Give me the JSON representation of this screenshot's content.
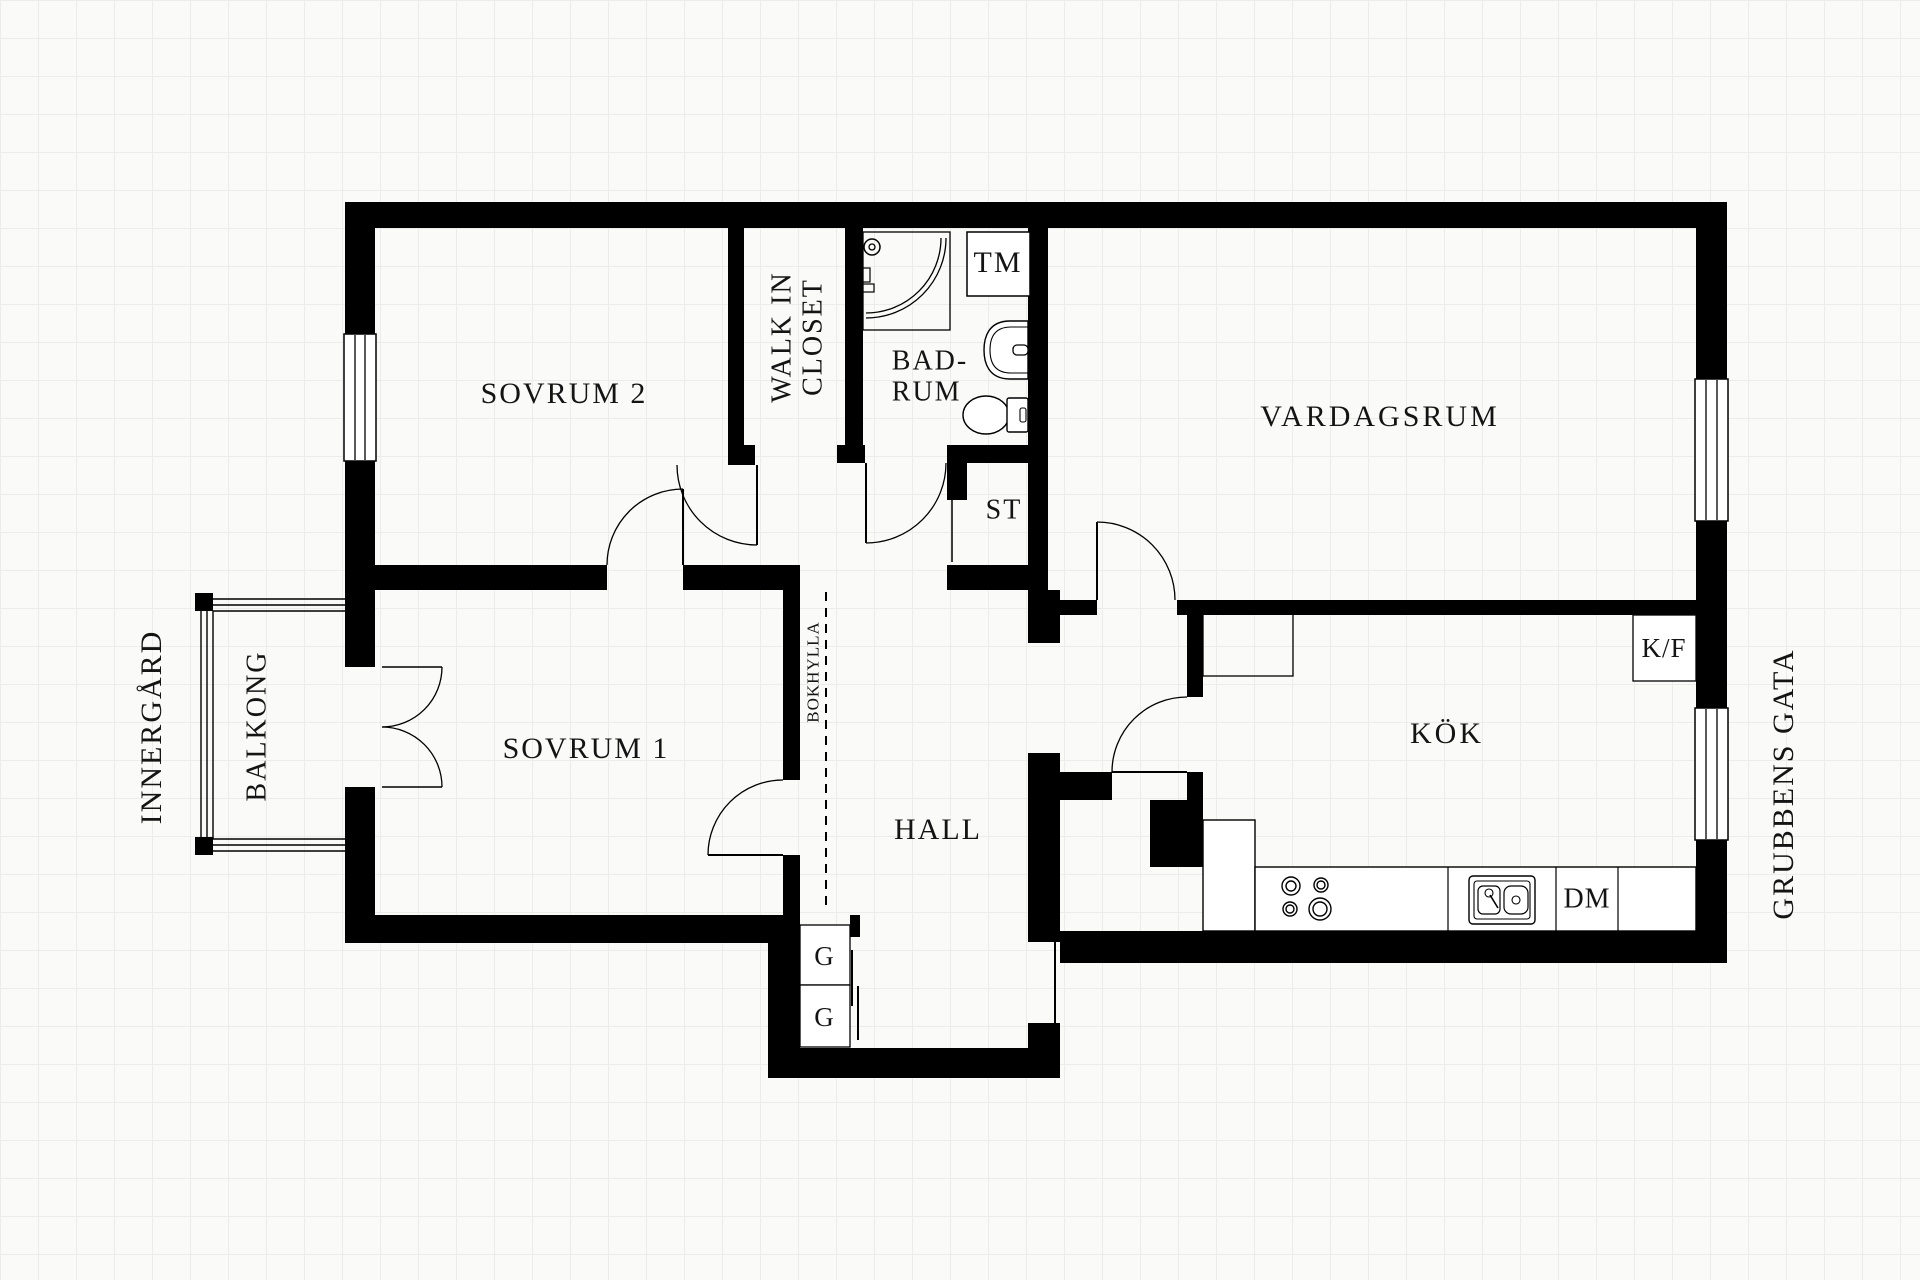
{
  "title": "Apartment floor plan",
  "colors": {
    "wall": "#000000",
    "background": "#fafaf9",
    "grid": "#ececea",
    "text": "#141414"
  },
  "rooms": {
    "sovrum2": {
      "label": "SOVRUM 2"
    },
    "walk_in_closet": {
      "line1": "WALK IN",
      "line2": "CLOSET"
    },
    "badrum": {
      "line1": "BAD-",
      "line2": "RUM"
    },
    "vardagsrum": {
      "label": "VARDAGSRUM"
    },
    "sovrum1": {
      "label": "SOVRUM 1"
    },
    "hall": {
      "label": "HALL"
    },
    "kok": {
      "label": "KÖK"
    },
    "balkong": {
      "label": "BALKONG"
    },
    "st_closet": {
      "label": "ST"
    }
  },
  "fixtures": {
    "tm": {
      "label": "TM"
    },
    "kf": {
      "label": "K/F"
    },
    "dm": {
      "label": "DM"
    },
    "g_upper": {
      "label": "G"
    },
    "g_lower": {
      "label": "G"
    },
    "bokhylla": {
      "label": "BOKHYLLA"
    }
  },
  "outside": {
    "innergard": {
      "label": "INNERGÅRD"
    },
    "grubbens_gata": {
      "label": "GRUBBENS GATA"
    }
  }
}
